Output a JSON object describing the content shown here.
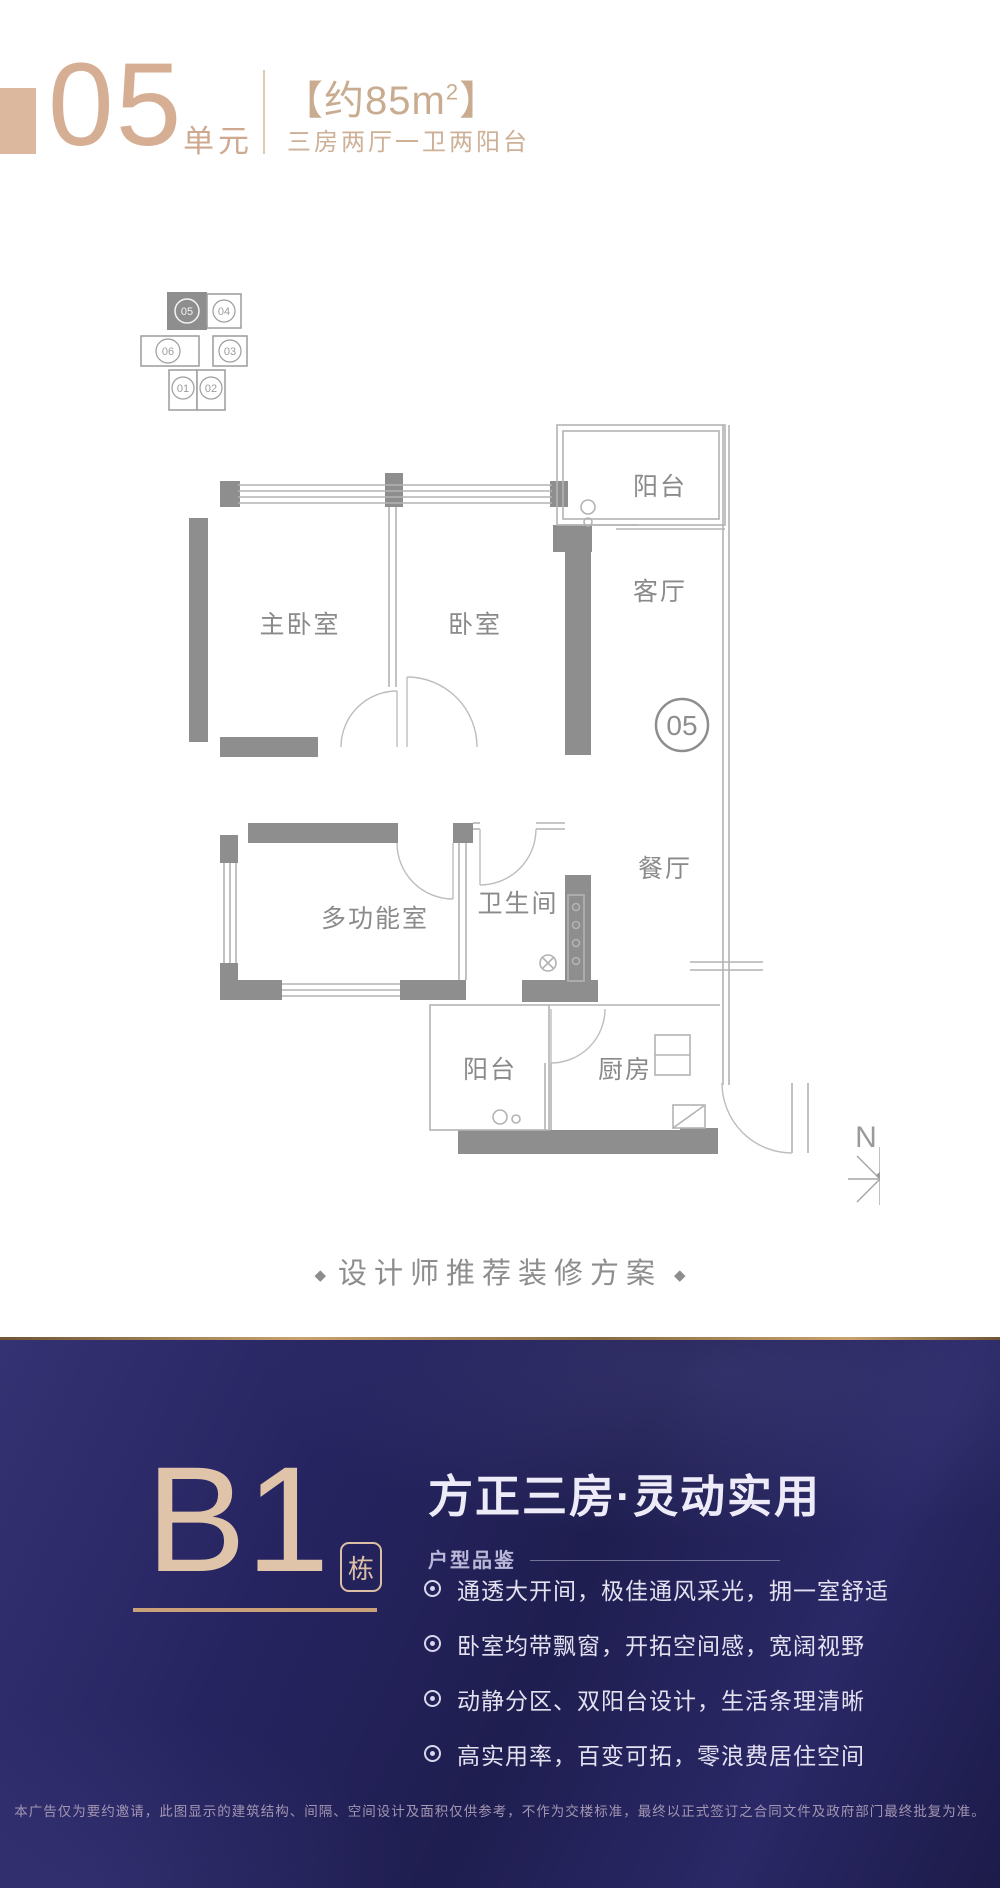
{
  "header": {
    "unit_number": "05",
    "unit_suffix": "单元",
    "area_text": "【约85m",
    "area_sup": "2",
    "area_close": "】",
    "layout_text": "三房两厅一卫两阳台"
  },
  "key_plan": {
    "highlighted": "05",
    "units": [
      {
        "id": "05"
      },
      {
        "id": "04"
      },
      {
        "id": "06"
      },
      {
        "id": "03"
      },
      {
        "id": "01"
      },
      {
        "id": "02"
      }
    ]
  },
  "floor_plan": {
    "labels": {
      "balcony_top": "阳台",
      "living": "客厅",
      "master_bedroom": "主卧室",
      "bedroom": "卧室",
      "unit_badge": "05",
      "dining": "餐厅",
      "multi_room": "多功能室",
      "bathroom": "卫生间",
      "balcony_bottom": "阳台",
      "kitchen": "厨房"
    },
    "north": "N"
  },
  "caption": {
    "diamond": "◆",
    "text": "设计师推荐装修方案"
  },
  "building": {
    "code": "B1",
    "suffix": "栋",
    "headline": "方正三房·灵动实用",
    "subhead": "户型品鉴",
    "features": [
      "通透大开间，极佳通风采光，拥一室舒适",
      "卧室均带飘窗，开拓空间感，宽阔视野",
      "动静分区、双阳台设计，生活条理清晰",
      "高实用率，百变可拓，零浪费居住空间"
    ],
    "disclaimer": "本广告仅为要约邀请，此图显示的建筑结构、间隔、空间设计及面积仅供参考，不作为交楼标准，最终以正式签订之合同文件及政府部门最终批复为准。"
  },
  "colors": {
    "tan": "#d5ae93",
    "tan_light": "#dcc0a6",
    "gold_line": "#c8a26e",
    "wall_gray": "#8e8e8e",
    "plan_text_gray": "#8a8a8a",
    "navy_bg": "#232159",
    "feature_text": "#e3e1f0"
  }
}
